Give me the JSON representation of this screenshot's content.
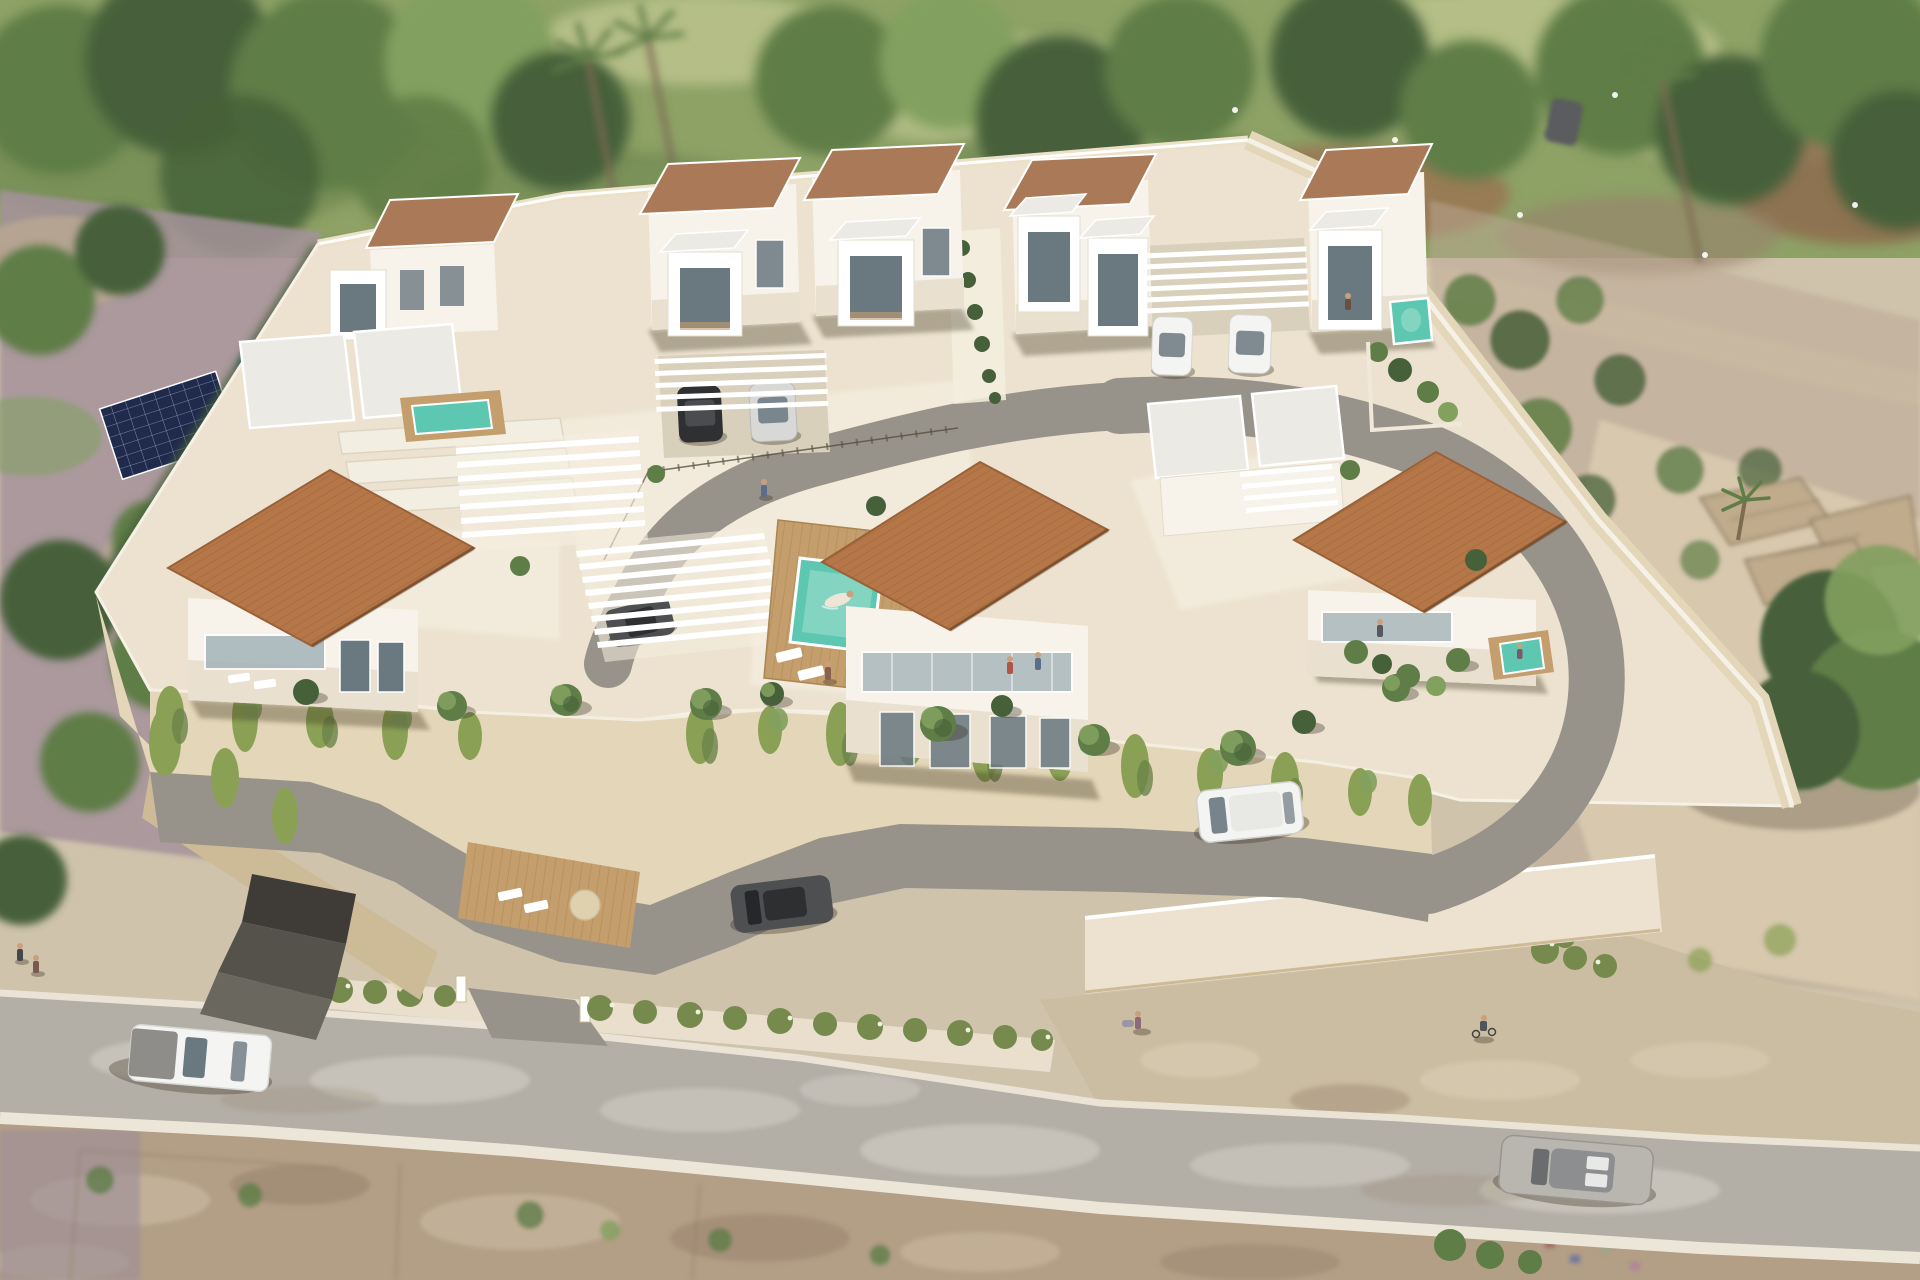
{
  "image": {
    "kind": "3d-architectural-aerial-render",
    "subject": "gated residential development of modern white villas with terracotta roofs",
    "view": "oblique aerial",
    "time_of_day": "day"
  },
  "scene": {
    "setting": "new-build villa complex on a cream-walled terraced plot, public road in front, green field with mature trees behind, dry scrubland and ruins to the right",
    "development": {
      "front_villas_with_terracotta_roofs": 3,
      "rear_villas_with_flat_brown_roofs": 5,
      "white_box_balconies": 7,
      "white_slatted_pergola_carports": 4,
      "communal_pool_with_wood_deck": true,
      "private_plunge_pools": 3,
      "retaining_wall_with_hanging_vines": true,
      "underground_garage_entrance": true,
      "hedge_with_white_flowers_along_street": true
    },
    "vehicles": {
      "parked_under_carports": 5,
      "driving_inside_development": 2,
      "on_public_road": 2,
      "distant_parked": 1,
      "total_visible": 10
    },
    "people": {
      "swimmer_in_pool": 1,
      "on_balconies": 3,
      "on_terraces": 2,
      "pedestrians": 4,
      "cyclist": 1
    },
    "surroundings": {
      "neighbor_pool": 1,
      "neighbor_solar_panel_array": 1,
      "palm_trees": 3,
      "stone_ruins_right": true,
      "dirt_lots_foreground": true,
      "white_birds_in_trees": 6
    }
  },
  "palette": {
    "meadow_base": "#8ea266",
    "meadow_light": "#bec68f",
    "meadow_dark": "#66804a",
    "tree_dark": "#46603a",
    "tree_mid": "#5f7d47",
    "tree_light": "#82a05e",
    "trunk_brown": "#7d6b52",
    "neighbor_ground": "#a5929a",
    "neighbor_tan": "#bba893",
    "water_blue": "#4a7ba4",
    "water_blue_light": "#82b4cf",
    "solar_navy": "#1f2a4d",
    "platform_cream": "#ece2cf",
    "platform_light": "#f5eee0",
    "wall_beige": "#e4d6b8",
    "wall_shade": "#cdbb97",
    "white": "#ffffff",
    "house_side": "#f7f3ea",
    "house_front": "#e9e0cf",
    "glass_dark": "#6a7880",
    "glass_light": "#9fb0b6",
    "roof_terracotta": "#b57748",
    "roof_terracotta_dark": "#9a6139",
    "roof_flat_brown": "#aa7a58",
    "roof_white_slab": "#eceae4",
    "deck_wood": "#c49e6d",
    "deck_wood_dark": "#a9854f",
    "pool_teal": "#5ec7b2",
    "pool_teal_light": "#93dcc9",
    "internal_road_gray": "#98938a",
    "garage_dark": "#55524c",
    "hedge_green": "#768a4e",
    "hedge_flower": "#eef1dc",
    "vine_green": "#8aa055",
    "vine_dark": "#6c834a",
    "public_road_gray": "#b3afa7",
    "road_patch_light": "#d2cec5",
    "curb_white": "#ece6d8",
    "dirt_tan": "#b39e86",
    "dirt_dark": "#97826c",
    "rubble_light": "#c9b99f",
    "ruin_stone": "#c0ab8c",
    "ruin_line": "#8d7a60",
    "car_black": "#2f3032",
    "car_silver": "#d8d8d6",
    "car_white": "#f4f4f2",
    "car_gray": "#b9b6b0",
    "car_dark_gray": "#4e4f51",
    "shadow": "rgba(60,50,35,0.35)"
  }
}
